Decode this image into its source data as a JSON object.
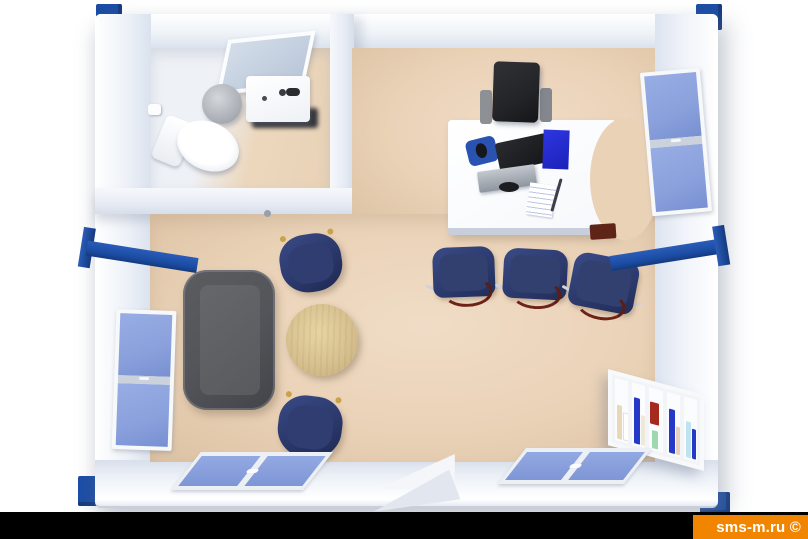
{
  "watermark": {
    "text": "sms-m.ru ©",
    "bar_color": "#F28500",
    "text_color": "#FFFFFF"
  },
  "scene": {
    "kind": "3d-top-down-floor-plan-render",
    "subject": "modular-office-container-with-bathroom",
    "palette": {
      "background": "#FFFFFF",
      "walls": "#F1F4F9",
      "floor": "#EAD2B7",
      "frame_accent_blue": "#1C4DA5",
      "window_glass_blue": "#8AA0DC",
      "seating_navy": "#2C3A6E",
      "sofa_gray": "#54555A",
      "table_wood": "#D8C190",
      "desk_white": "#FBFCFE",
      "office_chair_black": "#232428",
      "bottom_strip_black": "#000000"
    },
    "rooms": [
      {
        "name": "bathroom",
        "location": "top-left",
        "fixtures": [
          "toilet",
          "washbasin-with-faucet",
          "tilted-mirror",
          "waste-bin",
          "toilet-paper-roll",
          "door-handle"
        ]
      },
      {
        "name": "office-room",
        "location": "main",
        "furniture": [
          "white-desk-with-curved-edge",
          "black-office-chair",
          "flat-monitor",
          "keyboard",
          "blue-mouse-pad-with-mouse",
          "blue-folder",
          "document-with-pen",
          "red-under-desk-box",
          "navy-visitor-chair",
          "navy-visitor-chair",
          "navy-visitor-chair",
          "gray-sofa",
          "round-wood-coffee-table",
          "navy-armchair",
          "navy-armchair",
          "bookshelf-with-binders"
        ]
      }
    ],
    "openings": [
      "left-wall-window",
      "right-wall-window",
      "bottom-wall-double-window-left",
      "bottom-wall-double-window-right",
      "entrance-door-open-outward"
    ],
    "frame_details": [
      "corner-block-top-left",
      "corner-block-top-right",
      "corner-block-bottom-left",
      "corner-block-bottom-right",
      "blue-cross-beam-left-wall",
      "blue-cross-beam-right-wall"
    ]
  }
}
